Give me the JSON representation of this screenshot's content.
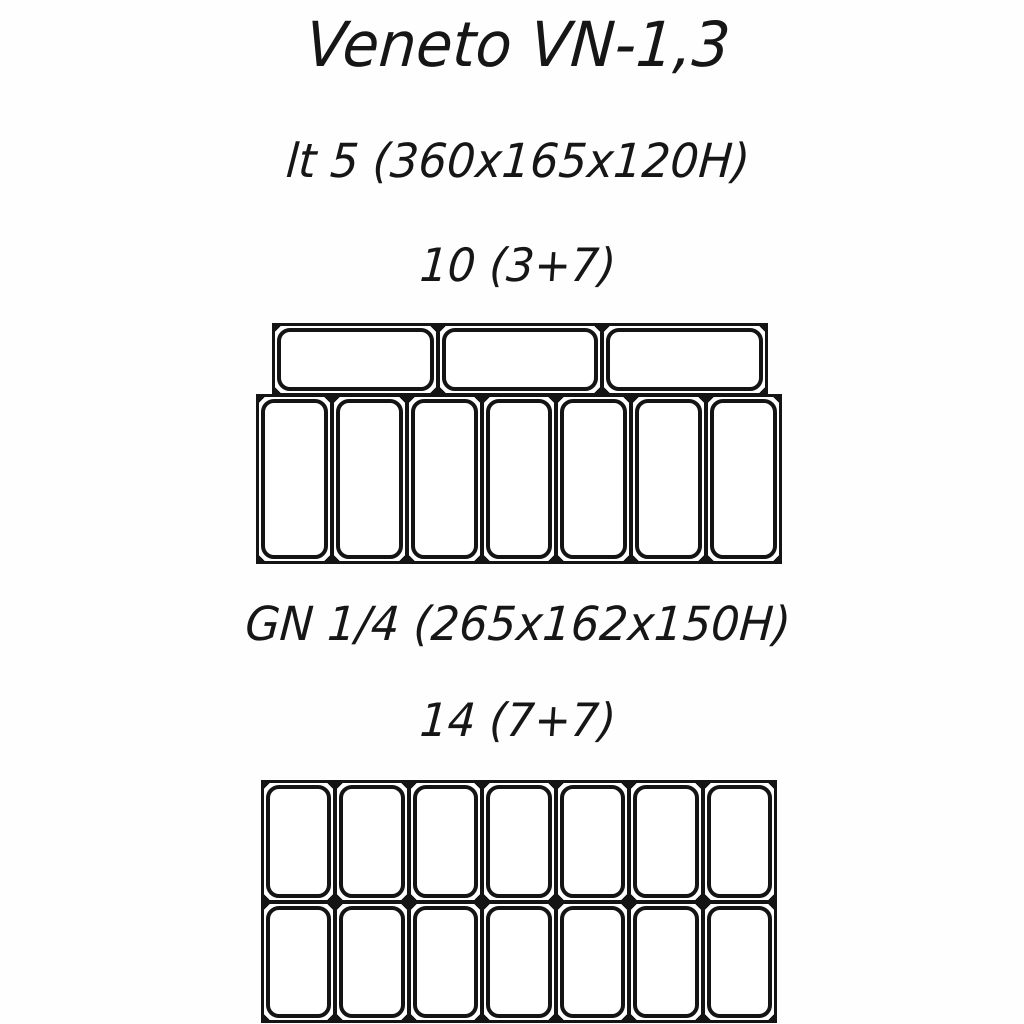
{
  "page": {
    "background_color": "#ffffff",
    "ink_color": "#141414"
  },
  "title": "Veneto VN-1,3",
  "config_1": {
    "pan_spec": "lt 5 (360x165x120H)",
    "count_label": "10 (3+7)",
    "top_row": {
      "pans": 3,
      "orientation": "landscape"
    },
    "bottom_row": {
      "pans": 7,
      "orientation": "portrait"
    }
  },
  "config_2": {
    "pan_spec": "GN 1/4 (265x162x150H)",
    "count_label": "14 (7+7)",
    "rows": 2,
    "columns": 7,
    "orientation": "portrait"
  }
}
